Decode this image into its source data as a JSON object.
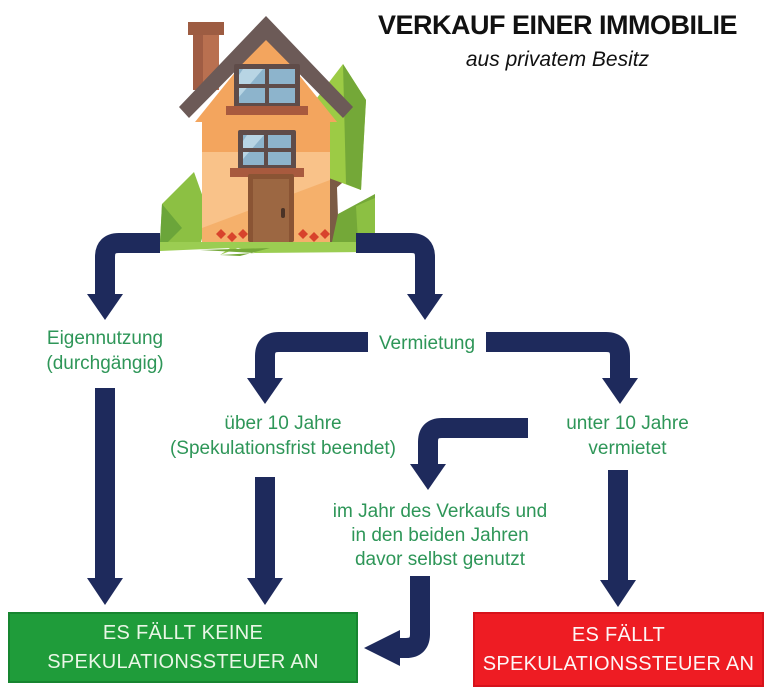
{
  "header": {
    "title": "VERKAUF EINER IMMOBILIE",
    "subtitle": "aus privatem Besitz"
  },
  "illustration": "cartoon-house-with-tree-and-bushes",
  "nodes": {
    "eigennutzung": {
      "line1": "Eigennutzung",
      "line2": "(durchgängig)"
    },
    "vermietung": {
      "label": "Vermietung"
    },
    "ueber10": {
      "line1": "über 10 Jahre",
      "line2": "(Spekulationsfrist beendet)"
    },
    "unter10": {
      "line1": "unter 10 Jahre",
      "line2": "vermietet"
    },
    "selbstgenutzt": {
      "line1": "im Jahr des Verkaufs und",
      "line2": "in den beiden Jahren",
      "line3": "davor selbst genutzt"
    }
  },
  "outcomes": {
    "no_tax": {
      "line1": "ES FÄLLT KEINE",
      "line2": "SPEKULATIONSSTEUER AN"
    },
    "tax": {
      "line1": "ES FÄLLT",
      "line2": "SPEKULATIONSSTEUER AN"
    }
  },
  "colors": {
    "arrow": "#1e2a5c",
    "label_green": "#2e9658",
    "green_box": "#1f9c3a",
    "red_box": "#ee1c23",
    "box_text_green": "#eaf6e6",
    "box_text_red": "#fdf6f6",
    "title_text": "#111111"
  }
}
